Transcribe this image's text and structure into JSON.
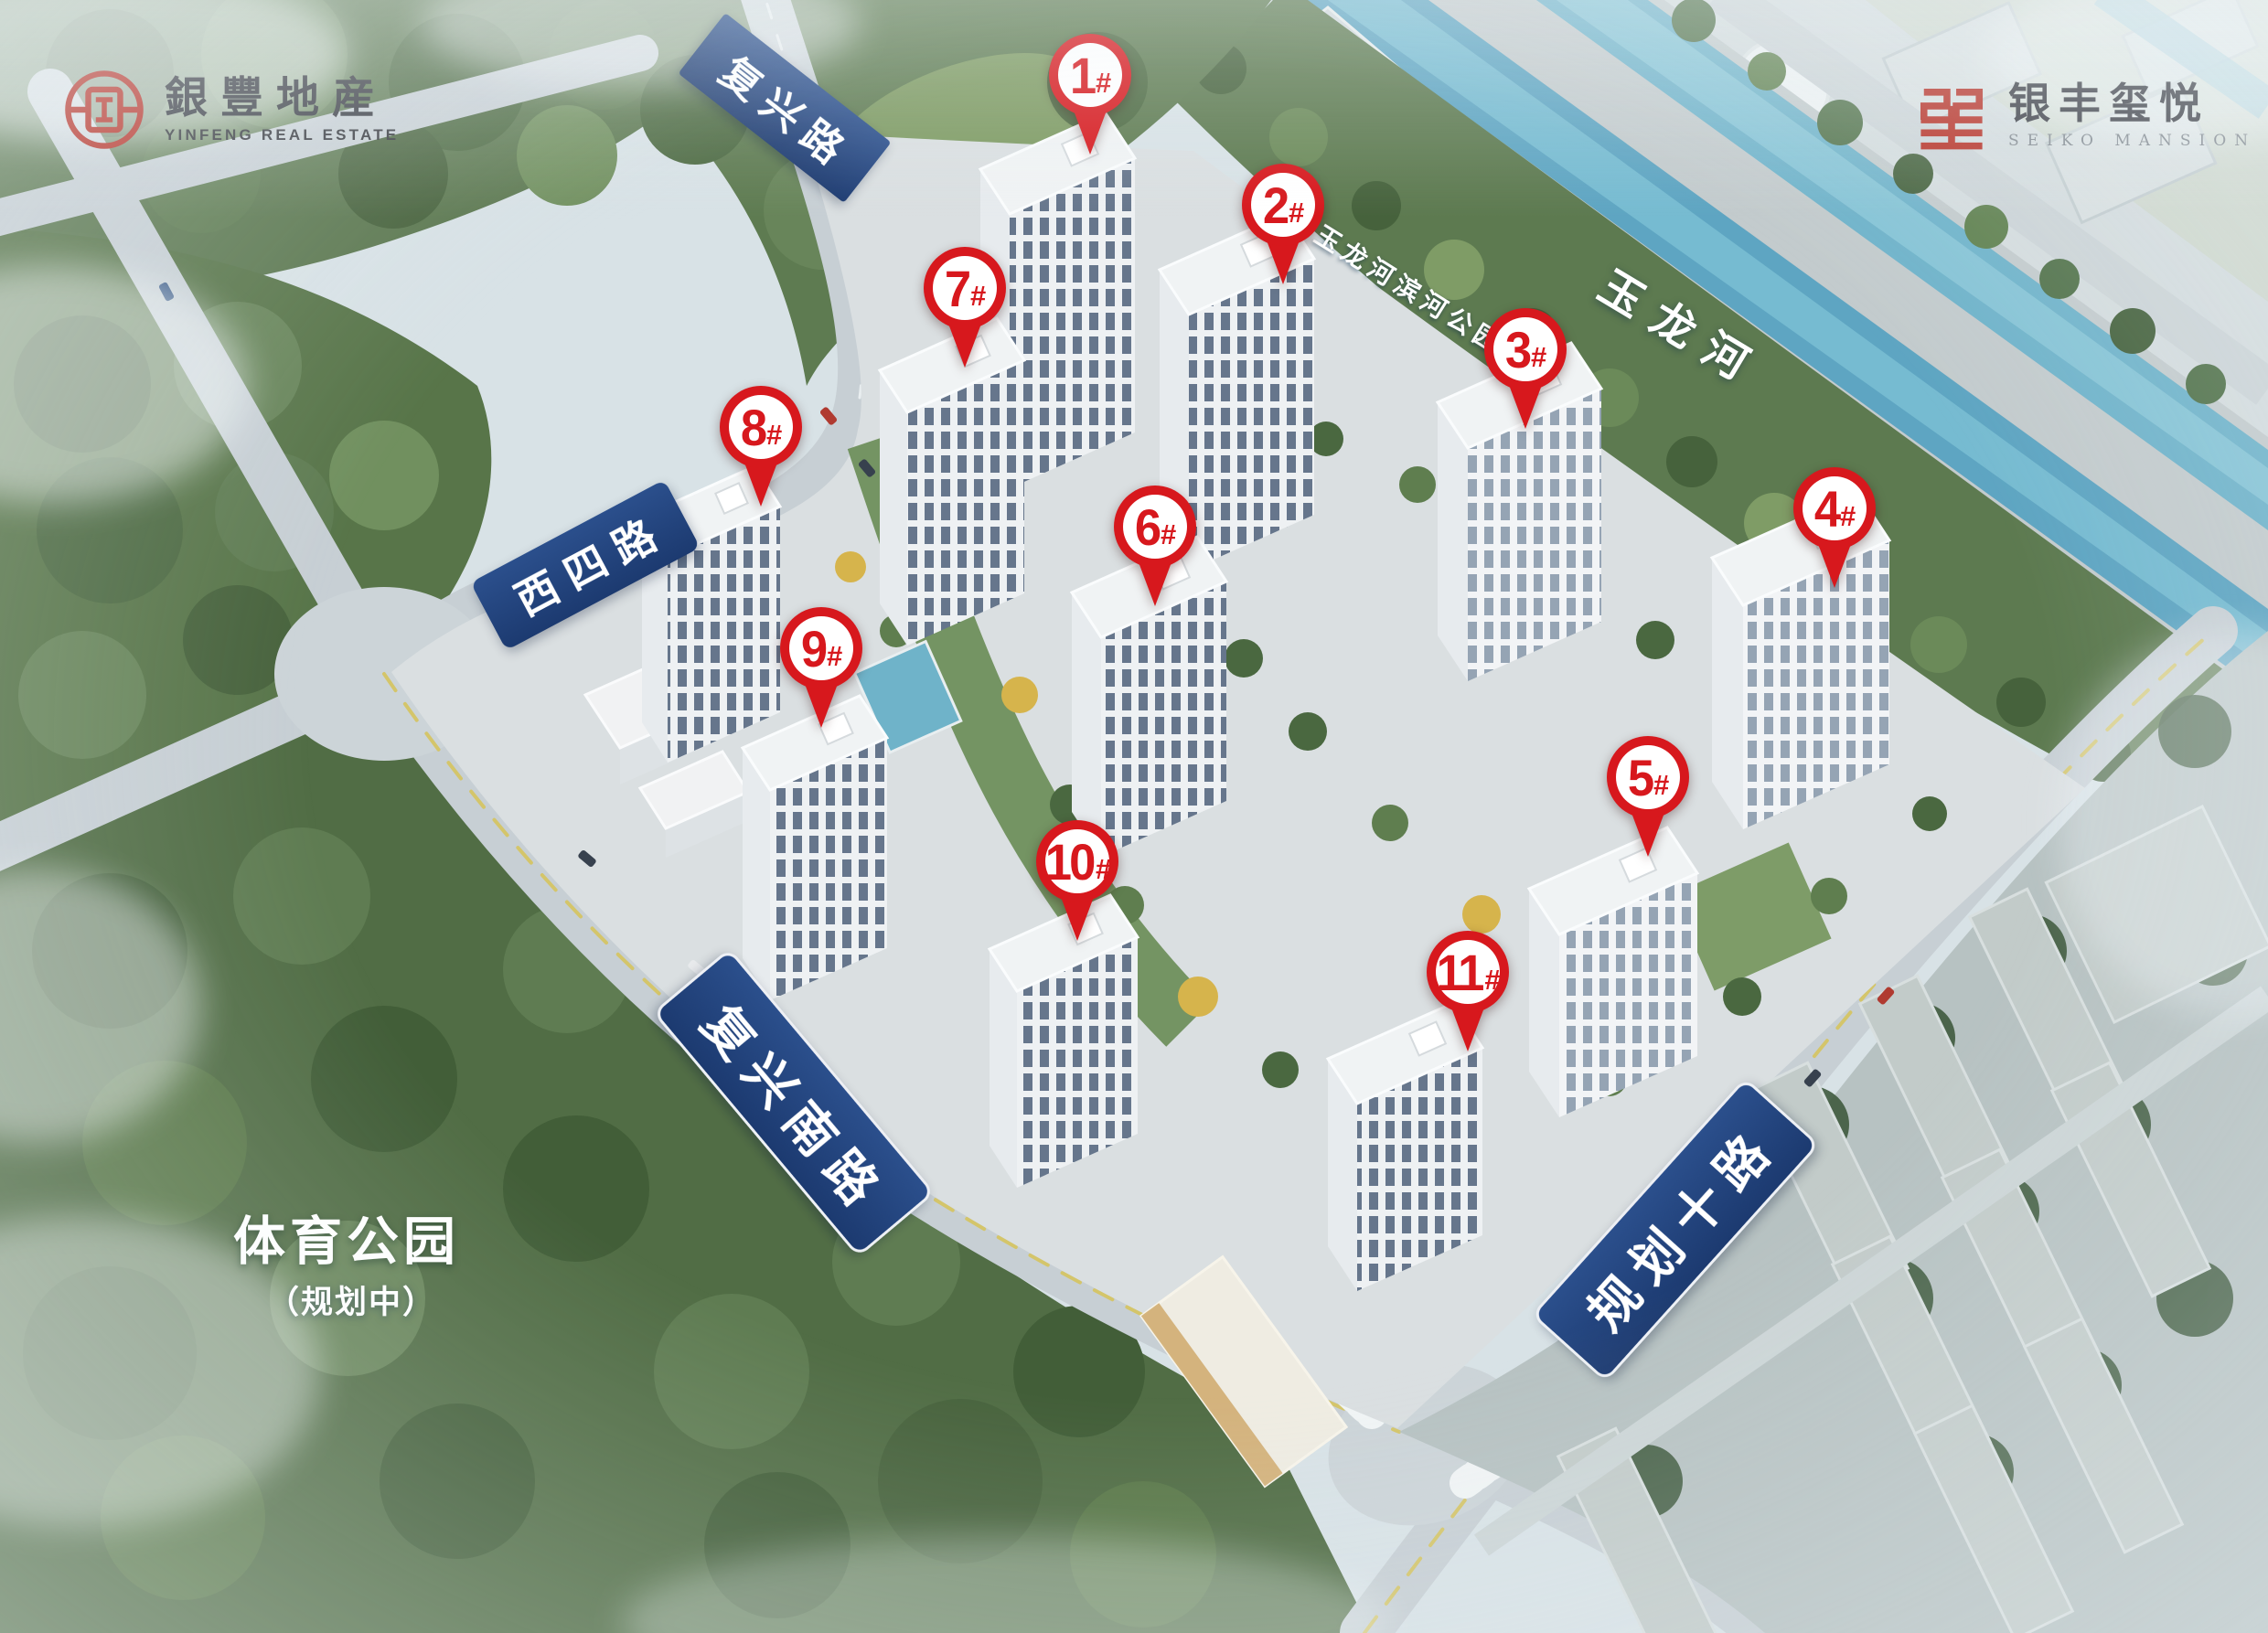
{
  "branding": {
    "developer": {
      "name_zh": "銀豐地産",
      "name_en": "YINFENG REAL ESTATE"
    },
    "project": {
      "name_zh": "银丰玺悦",
      "name_en": "SEIKO MANSION"
    }
  },
  "map_labels": {
    "river": "玉龙河",
    "riverside_park": "玉龙河滨河公园",
    "road_north": "复兴路",
    "road_west": "西四路",
    "road_south": "复兴南路",
    "road_east": "规划十路",
    "sports_park": "体育公园",
    "sports_park_status": "（规划中）"
  },
  "markers": [
    {
      "num": "1",
      "suffix": "#"
    },
    {
      "num": "2",
      "suffix": "#"
    },
    {
      "num": "3",
      "suffix": "#"
    },
    {
      "num": "4",
      "suffix": "#"
    },
    {
      "num": "5",
      "suffix": "#"
    },
    {
      "num": "6",
      "suffix": "#"
    },
    {
      "num": "7",
      "suffix": "#"
    },
    {
      "num": "8",
      "suffix": "#"
    },
    {
      "num": "9",
      "suffix": "#"
    },
    {
      "num": "10",
      "suffix": "#"
    },
    {
      "num": "11",
      "suffix": "#"
    }
  ],
  "colors": {
    "marker_red": "#d7181d",
    "banner_blue": "#21467f",
    "seal_red": "#b5281d",
    "river_water": "#5ea5c2",
    "forest_green": "#56714c"
  }
}
